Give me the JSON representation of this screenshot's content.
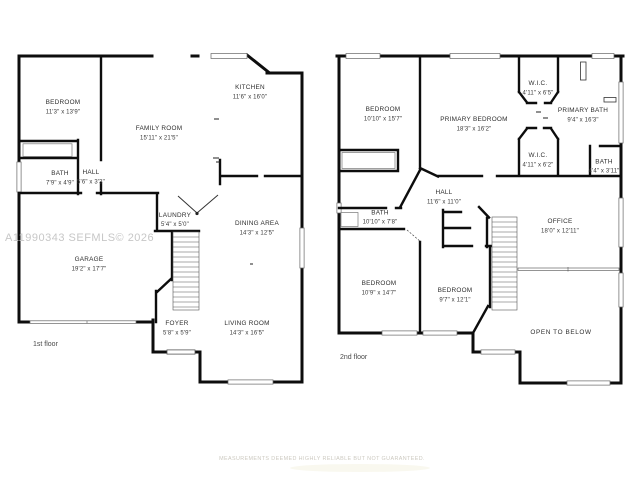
{
  "watermark": "A11990343 SEFMLS© 2026",
  "disclaimer": "MEASUREMENTS DEEMED HIGHLY RELIABLE BUT NOT GUARANTEED.",
  "floor1": {
    "label": "1st floor",
    "rooms": [
      {
        "name": "BEDROOM",
        "dims": "11'3\" x 13'9\""
      },
      {
        "name": "FAMILY ROOM",
        "dims": "15'11\" x 21'5\""
      },
      {
        "name": "KITCHEN",
        "dims": "11'6\" x 16'0\""
      },
      {
        "name": "BATH",
        "dims": "7'9\" x 4'9\""
      },
      {
        "name": "HALL",
        "dims": "5'6\" x 3'3\""
      },
      {
        "name": "LAUNDRY",
        "dims": "5'4\" x 5'0\""
      },
      {
        "name": "DINING AREA",
        "dims": "14'3\" x 12'5\""
      },
      {
        "name": "GARAGE",
        "dims": "19'2\" x 17'7\""
      },
      {
        "name": "FOYER",
        "dims": "5'8\" x 5'9\""
      },
      {
        "name": "LIVING ROOM",
        "dims": "14'3\" x 16'5\""
      }
    ]
  },
  "floor2": {
    "label": "2nd floor",
    "rooms": [
      {
        "name": "BEDROOM",
        "dims": "10'10\" x 15'7\""
      },
      {
        "name": "PRIMARY BEDROOM",
        "dims": "18'3\" x 16'2\""
      },
      {
        "name": "W.I.C.",
        "dims": "4'11\" x 6'5\""
      },
      {
        "name": "PRIMARY BATH",
        "dims": "9'4\" x 16'3\""
      },
      {
        "name": "W.I.C.",
        "dims": "4'11\" x 6'2\""
      },
      {
        "name": "BATH",
        "dims": "4'4\" x 3'11\""
      },
      {
        "name": "HALL",
        "dims": "11'6\" x 11'0\""
      },
      {
        "name": "BATH",
        "dims": "10'10\" x 7'8\""
      },
      {
        "name": "OFFICE",
        "dims": "18'0\" x 12'11\""
      },
      {
        "name": "BEDROOM",
        "dims": "10'9\" x 14'7\""
      },
      {
        "name": "BEDROOM",
        "dims": "9'7\" x 12'1\""
      },
      {
        "name": "OPEN TO BELOW",
        "dims": ""
      }
    ]
  }
}
